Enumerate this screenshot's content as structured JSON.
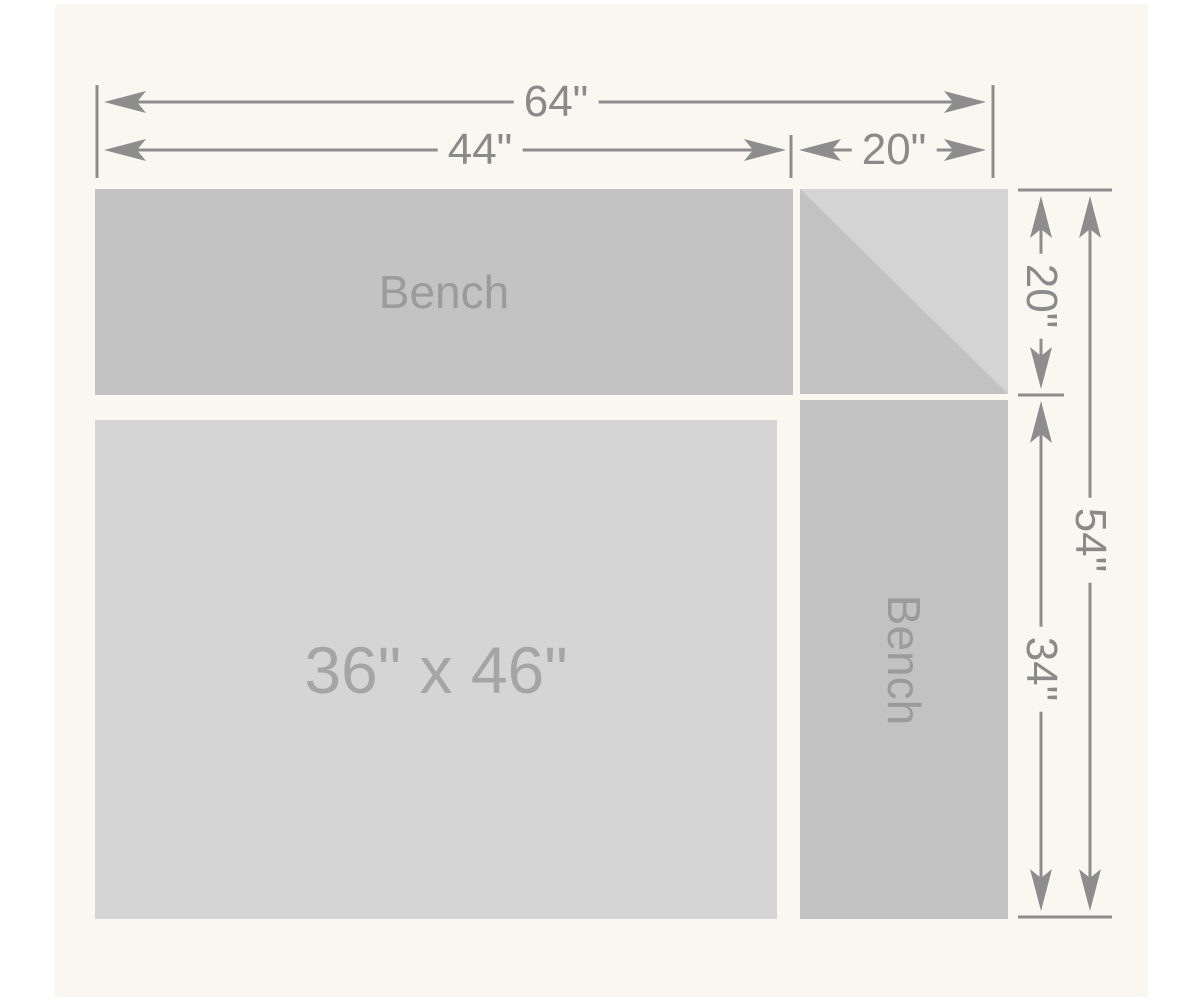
{
  "labels": {
    "bench_top": "Bench",
    "bench_right": "Bench",
    "area_size": "36\" x 46\""
  },
  "dimensions": {
    "top_total": "64\"",
    "top_left_section": "44\"",
    "top_right_section": "20\"",
    "right_top_section": "20\"",
    "right_total": "54\"",
    "right_bottom_section": "34\""
  },
  "colors": {
    "page_background": "#ffffff",
    "panel_background": "#faf6f0",
    "bench_fill": "#c3c3c3",
    "area_fill": "#d5d5d5",
    "corner_light_fill": "#d4d4d4",
    "corner_dark_fill": "#c2c2c2",
    "dimension_line": "#8d8d8d",
    "dimension_text": "#8a8a8a",
    "bench_label_text": "#9b9b9b",
    "area_label_text": "#a5a5a5"
  }
}
